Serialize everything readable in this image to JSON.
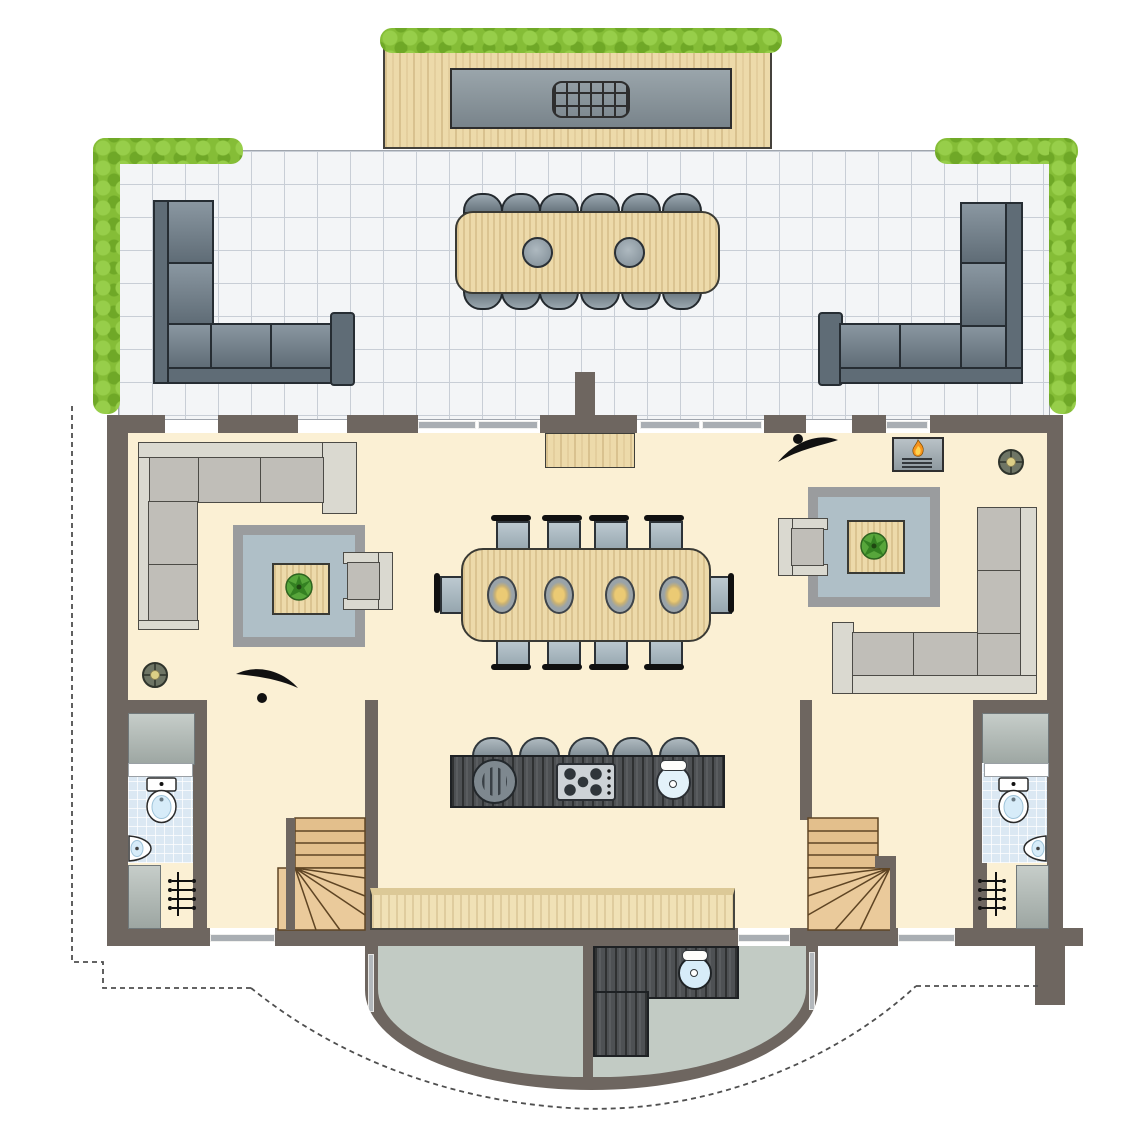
{
  "palette": {
    "wall": "#6E6660",
    "interior_floor": "#FBF0D4",
    "terrace_tile": "#F3F5F7",
    "tile_line": "#C8CED6",
    "hedge_green": "#85BD37",
    "wood_light": "#EDDAAA",
    "wood_stair": "#E3BF8C",
    "counter_dark_wood": "#4E5154",
    "outdoor_sofa": "#5F6C76",
    "indoor_sofa_frame": "#DAD9D0",
    "indoor_sofa_cushion": "#C0BEB8",
    "rug_outer": "#9A9C9E",
    "rug_inner": "#AFBFC7",
    "chair_seat": "#AEBDC4",
    "bathroom_tile": "#DBE8F3",
    "porcelain": "#FFFFFF",
    "water_blue": "#D7ECF9",
    "porch_floor": "#C2CBC4",
    "closet_gray": "#B3BCB8",
    "plant_green": "#57A63B",
    "flame_orange": "#F7941D",
    "dashed_line": "#4F4F4F"
  },
  "icons": [
    "hedge",
    "bbq-grill",
    "outdoor-corner-sofa",
    "outdoor-dining-chair",
    "parasol-insert",
    "indoor-corner-sofa",
    "armchair",
    "area-rug",
    "coffee-table",
    "potted-plant",
    "ceiling-light",
    "swing-door",
    "fireplace-flame",
    "dining-chair",
    "place-setting",
    "bar-stool",
    "round-grill",
    "cooktop-5-burner",
    "kitchen-sink",
    "toilet",
    "corner-basin",
    "radiator",
    "winder-staircase",
    "closet",
    "bench",
    "porch-counter-sink",
    "site-boundary-dashed"
  ],
  "scene": {
    "balcony": {
      "bbq_counters": 1,
      "grills": 1,
      "hedge_rows": 1
    },
    "terrace": {
      "corner_sofas": 2,
      "dining_chairs": 12,
      "parasol_inserts": 2,
      "hedge_strips": 4
    },
    "living_areas": {
      "count": 2,
      "corner_sofas": 2,
      "armchairs": 2,
      "rugs": 2,
      "coffee_tables_with_plant": 2,
      "ceiling_lights": 2,
      "swing_doors": 2,
      "fireplaces": 1
    },
    "dining_area": {
      "chairs": 10,
      "place_settings": 4
    },
    "kitchen_island": {
      "bar_stools": 5,
      "burners": 5,
      "sinks": 1,
      "round_grills": 1
    },
    "bathrooms": {
      "count": 2,
      "toilets": 2,
      "corner_basins": 2
    },
    "staircases": {
      "count": 2
    },
    "closets": {
      "count": 4
    },
    "radiators": {
      "count": 2
    },
    "porch": {
      "counter_sinks": 1,
      "wall_piers": 1
    }
  }
}
